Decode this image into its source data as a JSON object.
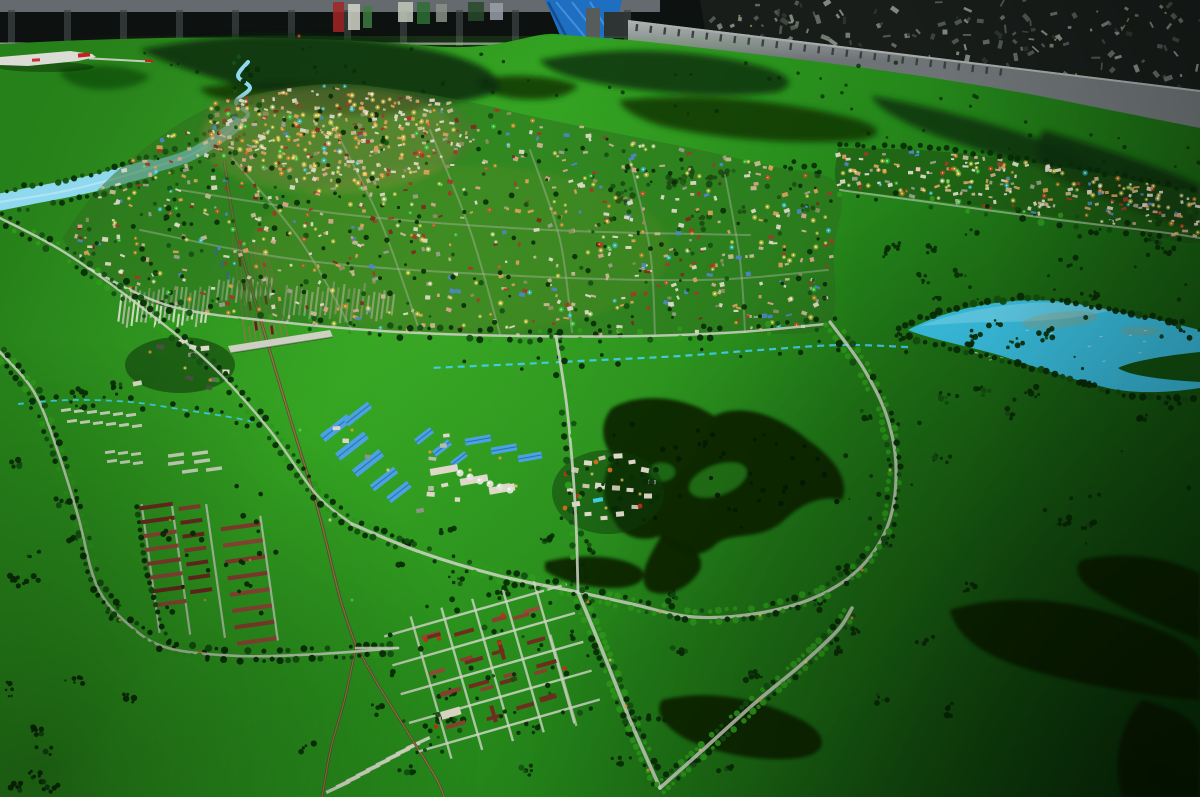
{
  "scene": {
    "kind": "photograph-of-city-scale-model",
    "landmarks": [
      "backdrop-wall",
      "blue-tarp",
      "background-city-mural",
      "model-platform-edge",
      "background-hills",
      "river",
      "lake",
      "city-model",
      "east-settlement-strip",
      "railway",
      "rail-yard",
      "warehouse-district",
      "village-cluster",
      "barracks-grid-district",
      "barracks-rows-district",
      "field-plots",
      "forest-patches",
      "tree-lined-roads",
      "model-airplane"
    ]
  },
  "palette": {
    "wall_dark": "#0d1110",
    "wall_top": "#646a6d",
    "wall_rib": "#3e4446",
    "baseboard": "#c7cdc7",
    "tarp_blue": "#1e6fc2",
    "tarp_fold": "#5aa6e6",
    "tarp_dark": "#113f77",
    "pole_light": "#565c5c",
    "pole_dark": "#2e3434",
    "mural_base": "#181d1a",
    "mural_green": "#8fae4f",
    "platform_light": "#aab0ae",
    "platform_mid": "#6e7476",
    "platform_slat": "#3a3f41",
    "platform_shadow": "#23282a",
    "terrain_a": "#27811a",
    "terrain_b": "#2f9e1f",
    "terrain_c": "#26891b",
    "terrain_d": "#1a6513",
    "terrain_e": "#0e470d",
    "terrain_hi": "#4cbb30",
    "grass_mid": "#237c18",
    "grass_dark": "#145511",
    "hill_dark": "#0b3108",
    "forest_dark": "#072705",
    "tree_dark": "#0a2e07",
    "tree_mid": "#155113",
    "tree_bright": "#2e9a1b",
    "road_light": "#cfd5c5",
    "road_faint": "#aab3a0",
    "rail_tan": "#8a7648",
    "rail_dark": "#554729",
    "bridge_white": "#ccd1c2",
    "river_blue": "#8fd9ef",
    "stream_cyan": "#41cdea",
    "lake_cyan": "#3cc6e8",
    "lake_light": "#82e0f5",
    "lake_sediment": "#b79f63",
    "bldg_white": "#ddd8c8",
    "bldg_tan": "#c9b795",
    "bldg_warm": "#d9a05c",
    "bldg_red": "#a23a28",
    "bldg_darkred": "#7c2c1d",
    "bldg_blue": "#4f86c6",
    "bldg_pink": "#d8a490",
    "bldg_olive": "#8f8f62",
    "bldg_gray": "#9aa08e",
    "roof_blue": "#4aa2e2",
    "roof_blue_dark": "#2e72ae",
    "tank_white": "#e2e5da",
    "barrack_red": "#8a4030",
    "barrack_dark": "#6e2d1f",
    "barrack_mid": "#934b38",
    "plot_white": "#d9ddcc",
    "plot_gray": "#b3baa2",
    "light_yellow": "#ffd966",
    "light_orange": "#ff9430",
    "light_red": "#ff4430",
    "light_green": "#4fe05a",
    "light_cyan": "#46d6ff",
    "light_white": "#fff3c8",
    "red_tree": "#c23014",
    "orange_tree": "#d86a1f",
    "train_red": "#5c221a",
    "container_blue": "#3f6fb5",
    "plane_white": "#dcdcd6",
    "plane_red": "#c32222",
    "strip_base": "#1d4f12",
    "mural_grays": [
      "#565d57",
      "#6b726a",
      "#7e857c",
      "#8d948c",
      "#434a44",
      "#2f3530"
    ],
    "poster_colors": [
      "#a32424",
      "#d5d5c8",
      "#3f7a41",
      "#c2c8ba",
      "#2f6e35",
      "#8a9089",
      "#274a2b",
      "#9aa0a8"
    ]
  },
  "density": {
    "mural_fragments": 150,
    "hill_trees": 60,
    "city_buildings": 620,
    "city_core_buildings": 180,
    "city_trees": 240,
    "city_lights": 200,
    "city_core_lights": 90,
    "strip_buildings": 170,
    "strip_lights": 85,
    "strip_trees": 45,
    "field_tree_clusters": 98,
    "forest_inner_trees": 45,
    "lake_speckles": 14
  }
}
